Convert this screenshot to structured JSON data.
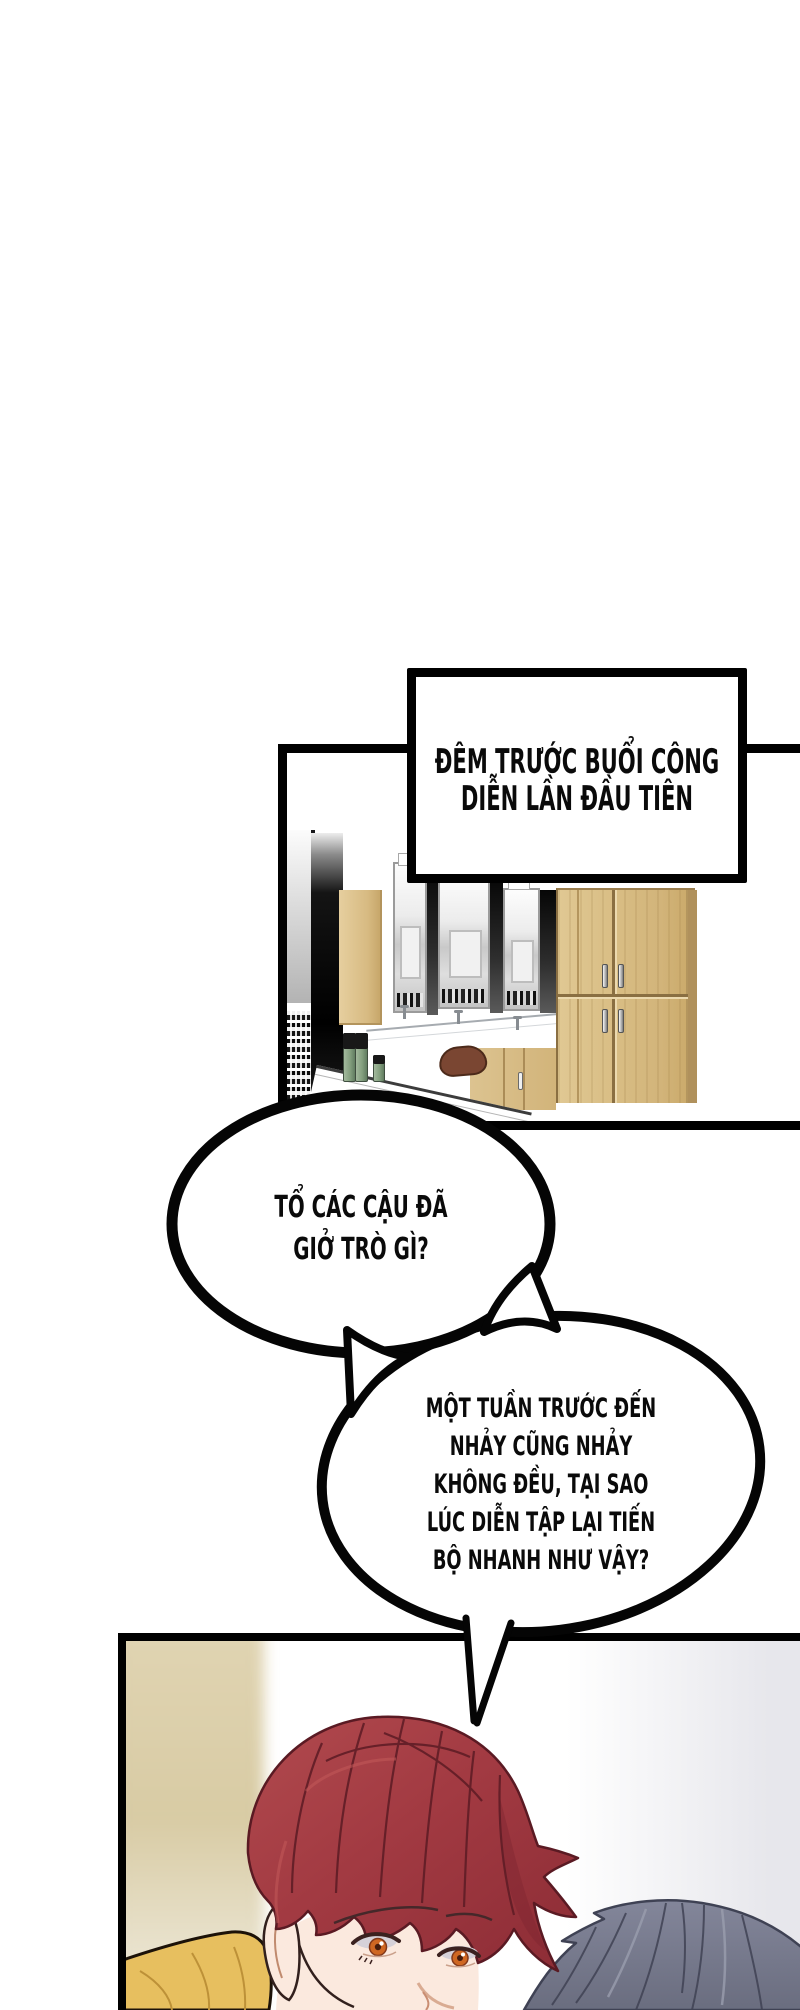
{
  "comic": {
    "caption": {
      "lines": [
        "ĐÊM TRƯỚC BUỔI CÔNG",
        "DIỄN LẦN ĐẦU TIÊN"
      ]
    },
    "bubble1": {
      "lines": [
        "TỔ CÁC CẬU ĐÃ",
        "GIỞ TRÒ GÌ?"
      ]
    },
    "bubble2": {
      "lines": [
        "MỘT TUẦN TRƯỚC ĐẾN",
        "NHẢY CŨNG NHẢY",
        "KHÔNG ĐỀU, TẠI SAO",
        "LÚC DIỄN TẬP LẠI TIẾN",
        "BỘ NHANH NHƯ VẬY?"
      ]
    },
    "colors": {
      "ink": "#000000",
      "paper": "#ffffff",
      "wood": "#d6bc8a",
      "bottle_green": "#84a07f",
      "chair_brown": "#7a4632",
      "hair_red": "#a23a42",
      "hair_red_dark": "#7f2630",
      "hair_gray": "#767989",
      "hair_gray_dark": "#3f4254",
      "shirt_yellow": "#e7bf5f",
      "skin": "#fbe9de",
      "eye_amber": "#cf6722"
    }
  }
}
